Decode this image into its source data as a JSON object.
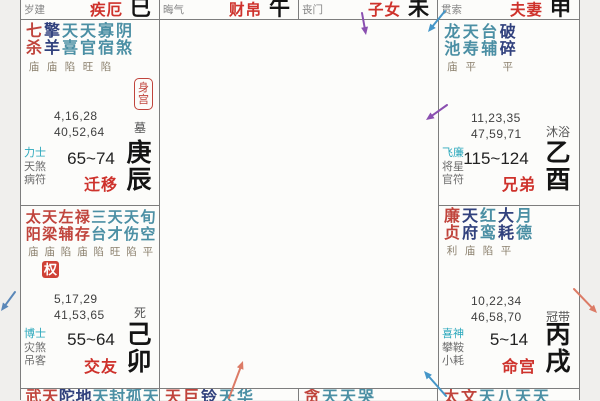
{
  "colors": {
    "star_red": "#c0443c",
    "star_navy": "#31417d",
    "star_teal": "#4b8fa4",
    "bright_gray": "#8a7f6c",
    "palace_red": "#ce322c",
    "god_cyan": "#2ba8bc",
    "god_gray": "#6d6d6d",
    "arrow_purple": "#8a4fb0",
    "arrow_blue": "#4596c8",
    "arrow_salmon": "#dc7b66",
    "arrow_steel": "#5a87b8"
  },
  "top_row": [
    {
      "god": "岁建",
      "palace": "疾厄",
      "branch": "巳"
    },
    {
      "god": "晦气",
      "palace": "财帛",
      "branch": "午"
    },
    {
      "god": "丧门",
      "palace": "子女",
      "branch": "未"
    },
    {
      "god": "贯索",
      "palace": "夫妻",
      "branch": "申"
    }
  ],
  "cells": {
    "chen": {
      "colw": 18,
      "stars": [
        {
          "t": "七",
          "b": "杀",
          "hex": "#c0443c",
          "br": "庙"
        },
        {
          "t": "擎",
          "b": "羊",
          "hex": "#31417d",
          "br": "庙"
        },
        {
          "t": "天",
          "b": "喜",
          "hex": "#4b8fa4",
          "br": "陷"
        },
        {
          "t": "天",
          "b": "官",
          "hex": "#4b8fa4",
          "br": "旺"
        },
        {
          "t": "寡",
          "b": "宿",
          "hex": "#4b8fa4",
          "br": "陷"
        },
        {
          "t": "阴",
          "b": "煞",
          "hex": "#4b8fa4",
          "br": ""
        }
      ],
      "body_badge": "身宫",
      "nums1": "4,16,28",
      "nums2": "40,52,64",
      "life": "墓",
      "gods": [
        "力士",
        "天煞",
        "病符"
      ],
      "decade": "65~74",
      "palace": "迁移",
      "stem": "庚",
      "branch": "辰"
    },
    "mao": {
      "colw": 16.4,
      "stars": [
        {
          "t": "太",
          "b": "阳",
          "hex": "#c0443c",
          "br": "庙"
        },
        {
          "t": "天",
          "b": "梁",
          "hex": "#c0443c",
          "br": "庙"
        },
        {
          "t": "左",
          "b": "辅",
          "hex": "#c0443c",
          "br": "陷"
        },
        {
          "t": "禄",
          "b": "存",
          "hex": "#c0443c",
          "br": "庙"
        },
        {
          "t": "三",
          "b": "台",
          "hex": "#4b8fa4",
          "br": "陷"
        },
        {
          "t": "天",
          "b": "才",
          "hex": "#4b8fa4",
          "br": "旺"
        },
        {
          "t": "天",
          "b": "伤",
          "hex": "#4b8fa4",
          "br": "陷"
        },
        {
          "t": "旬",
          "b": "空",
          "hex": "#4b8fa4",
          "br": "平"
        }
      ],
      "mutation": "权",
      "nums1": "5,17,29",
      "nums2": "41,53,65",
      "life": "死",
      "gods": [
        "博士",
        "灾煞",
        "吊客"
      ],
      "decade": "55~64",
      "palace": "交友",
      "stem": "己",
      "branch": "卯"
    },
    "you": {
      "colw": 18.5,
      "stars": [
        {
          "t": "龙",
          "b": "池",
          "hex": "#4b8fa4",
          "br": "庙"
        },
        {
          "t": "天",
          "b": "寿",
          "hex": "#4b8fa4",
          "br": "平"
        },
        {
          "t": "台",
          "b": "辅",
          "hex": "#4b8fa4",
          "br": ""
        },
        {
          "t": "破",
          "b": "碎",
          "hex": "#31417d",
          "br": "平"
        }
      ],
      "nums1": "11,23,35",
      "nums2": "47,59,71",
      "life": "沐浴",
      "gods": [
        "飞廉",
        "将星",
        "官符"
      ],
      "decade": "115~124",
      "palace": "兄弟",
      "stem": "乙",
      "branch": "酉"
    },
    "xu": {
      "colw": 18,
      "stars": [
        {
          "t": "廉",
          "b": "贞",
          "hex": "#c0443c",
          "br": "利"
        },
        {
          "t": "天",
          "b": "府",
          "hex": "#31417d",
          "br": "庙"
        },
        {
          "t": "红",
          "b": "鸾",
          "hex": "#4b8fa4",
          "br": "陷"
        },
        {
          "t": "大",
          "b": "耗",
          "hex": "#31417d",
          "br": "平"
        },
        {
          "t": "月",
          "b": "德",
          "hex": "#4b8fa4",
          "br": ""
        }
      ],
      "nums1": "10,22,34",
      "nums2": "46,58,70",
      "life": "冠带",
      "gods": [
        "喜神",
        "攀鞍",
        "小耗"
      ],
      "decade": "5~14",
      "palace": "命宫",
      "stem": "丙",
      "branch": "戌"
    }
  },
  "bottom_row": [
    {
      "chars": [
        {
          "ch": "武",
          "hex": "#c0443c"
        },
        {
          "ch": "天",
          "hex": "#c0443c"
        },
        {
          "ch": "陀",
          "hex": "#31417d"
        },
        {
          "ch": "地",
          "hex": "#31417d"
        },
        {
          "ch": "天",
          "hex": "#4b8fa4"
        },
        {
          "ch": "封",
          "hex": "#4b8fa4"
        },
        {
          "ch": "孤",
          "hex": "#4b8fa4"
        },
        {
          "ch": "天",
          "hex": "#4b8fa4"
        }
      ]
    },
    {
      "chars": [
        {
          "ch": "天",
          "hex": "#c0443c"
        },
        {
          "ch": "巨",
          "hex": "#c0443c"
        },
        {
          "ch": "铃",
          "hex": "#31417d"
        },
        {
          "ch": "天",
          "hex": "#4b8fa4"
        },
        {
          "ch": "华",
          "hex": "#4b8fa4"
        }
      ]
    },
    {
      "chars": [
        {
          "ch": "贪",
          "hex": "#c0443c"
        },
        {
          "ch": "天",
          "hex": "#4b8fa4"
        },
        {
          "ch": "天",
          "hex": "#4b8fa4"
        },
        {
          "ch": "哭",
          "hex": "#4b8fa4"
        }
      ]
    },
    {
      "chars": [
        {
          "ch": "太",
          "hex": "#c0443c"
        },
        {
          "ch": "文",
          "hex": "#c0443c"
        },
        {
          "ch": "天",
          "hex": "#4b8fa4"
        },
        {
          "ch": "八",
          "hex": "#4b8fa4"
        },
        {
          "ch": "天",
          "hex": "#4b8fa4"
        },
        {
          "ch": "天",
          "hex": "#4b8fa4"
        }
      ]
    }
  ],
  "arrows": [
    {
      "x1": 362,
      "y1": 13,
      "x2": 366,
      "y2": 35,
      "hex": "#8a4fb0"
    },
    {
      "x1": 445,
      "y1": 11,
      "x2": 428,
      "y2": 32,
      "hex": "#4596c8"
    },
    {
      "x1": 447,
      "y1": 105,
      "x2": 426,
      "y2": 120,
      "hex": "#8a4fb0"
    },
    {
      "x1": 574,
      "y1": 289,
      "x2": 597,
      "y2": 313,
      "hex": "#dc7b66"
    },
    {
      "x1": 446,
      "y1": 396,
      "x2": 424,
      "y2": 371,
      "hex": "#4596c8"
    },
    {
      "x1": 229,
      "y1": 398,
      "x2": 243,
      "y2": 361,
      "hex": "#dc7b66"
    },
    {
      "x1": 15,
      "y1": 292,
      "x2": 1,
      "y2": 311,
      "hex": "#5a87b8"
    }
  ]
}
